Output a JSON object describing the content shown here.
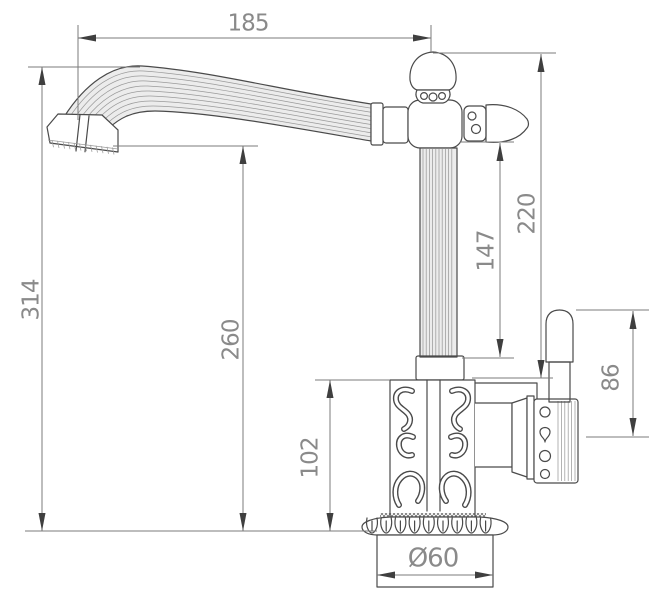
{
  "colors": {
    "background": "#ffffff",
    "outline": "#4a4a4a",
    "dimension_lines": "#7b7b7b",
    "dimension_text": "#8a8a8a"
  },
  "dimensions": {
    "spout_reach": "185",
    "overall_height": "314",
    "spout_outlet_height": "260",
    "head_to_body_top": "220",
    "side_knob_to_collar": "147",
    "body_section_height": "102",
    "handle_height": "86",
    "base_diameter": "Ø60"
  }
}
